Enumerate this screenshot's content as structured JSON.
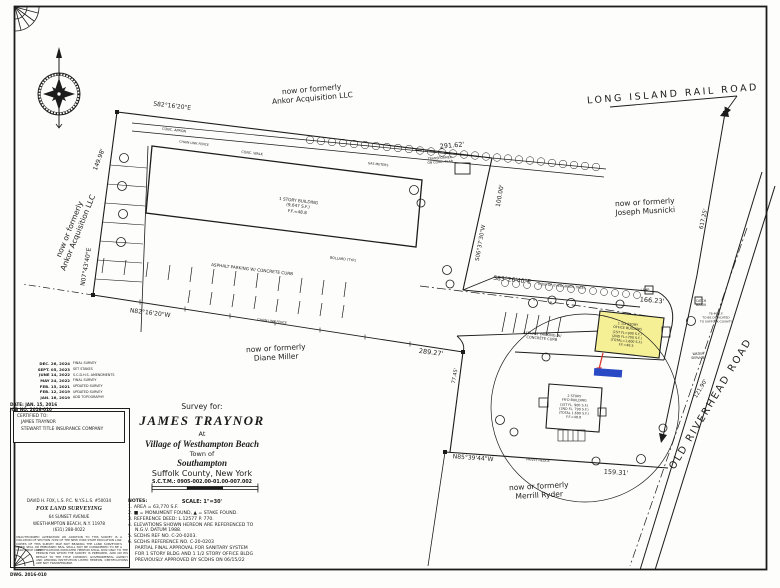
{
  "page": {
    "dwg": "DWG. 2016-010"
  },
  "roads": {
    "lirr": "LONG ISLAND RAIL ROAD",
    "old_riverhead": "OLD RIVERHEAD ROAD"
  },
  "adjoiners": {
    "prefix": "now or formerly",
    "ankor": "Ankor Acquisition LLC",
    "musnicki": "Joseph Musnicki",
    "miller": "Diane Miller",
    "ryder": "Merrill Ryder"
  },
  "dimensions": {
    "top_bearing": "S82°16'20\"E",
    "top_dist": "291.62'",
    "west_dist": "149.98'",
    "west_bearing": "N07°43'40\"E",
    "south_bearing": "N82°16'20\"W",
    "south_dist": "289.27'",
    "east_dist": "100.00'",
    "east_bearing": "S06°37'30\"W",
    "office_bearing": "S83°26'40\"E",
    "office_dist": "166.23'",
    "rail_dist": "617.25'",
    "road_dist": "121.90'",
    "lower_bearing": "N85°39'44\"W",
    "lower_dist": "159.31'",
    "side_dist": "77.45'"
  },
  "buildings": {
    "main": {
      "l1": "1 STORY BUILDING",
      "l2": "(9,647 S.F.)",
      "l3": "F.F.=48.8"
    },
    "office": {
      "l1": "1 1/2 STORY",
      "l2": "OFFICE BUILDING",
      "l3": "(1ST FL=900 S.F.)",
      "l4": "(2ND FL=700 S.F.)",
      "l5": "(TOTAL=1,600 S.F.)",
      "l6": "F.F.=48.5"
    },
    "house": {
      "l1": "2 STORY",
      "l2": "FR'D BUILDING",
      "l3": "(1ST FL. 900 S.F.)",
      "l4": "(2ND FL. 790 S.F.)",
      "l5": "(TOTAL 1,690 S.F.)",
      "l6": "F.F.=48.8"
    }
  },
  "site": {
    "parking1": "ASPHALT PARKING W/ CONCRETE CURB",
    "parking2a": "ASPHALT PARKING W/",
    "parking2b": "CONCRETE CURB",
    "conc_apron": "CONC. APRON",
    "clf": "CHAIN LINK FENCE",
    "conc_walk": "CONC. WALK",
    "evergreens": "ROW OF EVERGREEN TREES",
    "transformer_a": "TRANSFORMER",
    "transformer_b": "ON CONC. SLAB",
    "gas_meters": "GAS METERS",
    "bollard": "BOLLARD (TYP.)",
    "privet": "PRIVET HEDGE",
    "catch_a": "CATCH",
    "catch_b": "BASIN",
    "lamp": "LAMP",
    "dedicate_a": "78.46 S.F.",
    "dedicate_b": "TO BE DEDICATED",
    "dedicate_c": "TO SUFFOLK COUNTY",
    "water_a": "WATER",
    "water_b": "SERVICE"
  },
  "titleblock": {
    "survey_for": "Survey for:",
    "client": "JAMES TRAYNOR",
    "at": "At",
    "village": "Village of Westhampton Beach",
    "town_of": "Town of",
    "town": "Southampton",
    "county": "Suffolk County, New York",
    "sctm": "S.C.T.M.: 0905-002.00-01.00-007.002",
    "scale": "SCALE: 1\"=30'"
  },
  "notes": {
    "lines": [
      "NOTES:",
      "1. AREA = 63,770 S.F.",
      "2. ■ = MONUMENT FOUND,  ▲ = STAKE FOUND.",
      "3. REFERENCE DEED: L.12577 P. 770.",
      "4. ELEVATIONS SHOWN HEREON ARE REFERENCED TO",
      "    N.G.V. DATUM 1988.",
      "5. SCDHS REF NO. C-20-0203.",
      "6. SCDHS REFERENCE NO. C-20-0203",
      "    PARTIAL FINAL APPROVAL FOR SANITARY SYSTEM",
      "    FOR 1 STORY BLDG AND 1 1/2 STORY OFFICE BLDG",
      "    PREVIOUSLY APPROVED BY SCDHS ON 06/15/22"
    ]
  },
  "revisions": {
    "rows": [
      {
        "date": "DEC. 26, 2024",
        "note": "FINAL SURVEY"
      },
      {
        "date": "SEPT. 05, 2023",
        "note": "SET STAKES"
      },
      {
        "date": "JUNE 14, 2022",
        "note": "S.C.D.H.S. AMENDMENTS"
      },
      {
        "date": "MAY 24, 2022",
        "note": "FINAL SURVEY"
      },
      {
        "date": "FEB. 15, 2021",
        "note": "UPDATED SURVEY"
      },
      {
        "date": "FEB. 12, 2019",
        "note": "UPDATED SURVEY"
      },
      {
        "date": "JAN. 16, 2019",
        "note": "ADD TOPOGRAPHY"
      }
    ],
    "date_line": "DATE: JAN. 15, 2016",
    "job_line": "JOB NO. 2016-010"
  },
  "certified": {
    "heading": "CERTIFIED TO:",
    "l1": "JAMES TRAYNOR",
    "l2": "STEWART TITLE INSURANCE COMPANY"
  },
  "surveyor": {
    "principal": "DAVID H. FOX, L.S. P.C.   N.Y.S.L.S. #50034",
    "firm": "FOX LAND SURVEYING",
    "addr1": "64 SUNSET AVENUE",
    "addr2": "WESTHAMPTON BEACH, N.Y. 11978",
    "phone": "(631) 288-0022",
    "disclaimer1": "UNAUTHORIZED ALTERATION OR ADDITION TO THIS SURVEY IS A VIOLATION OF SECTION 7209 OF THE NEW YORK STATE EDUCATION LAW. COPIES OF THIS SURVEY MAP NOT BEARING THE LAND SURVEYOR'S INKED SEAL OR EMBOSSED SEAL SHALL NOT BE CONSIDERED TO BE A VALID TRUE COPY.",
    "disclaimer2": "CERTIFICATIONS INDICATED HEREON SHALL RUN ONLY TO THE PERSON FOR WHOM THE SURVEY IS PREPARED, AND ON HIS BEHALF TO THE TITLE COMPANY, GOVERNMENTAL AGENCY AND LENDING INSTITUTION LISTED HEREON. CERTIFICATIONS ARE NOT TRANSFERABLE."
  },
  "colors": {
    "highlight_yellow": "#f5f096",
    "highlight_blue": "#2a49c5",
    "arrow_red": "#d8352b",
    "ink": "#1c1c1c"
  }
}
